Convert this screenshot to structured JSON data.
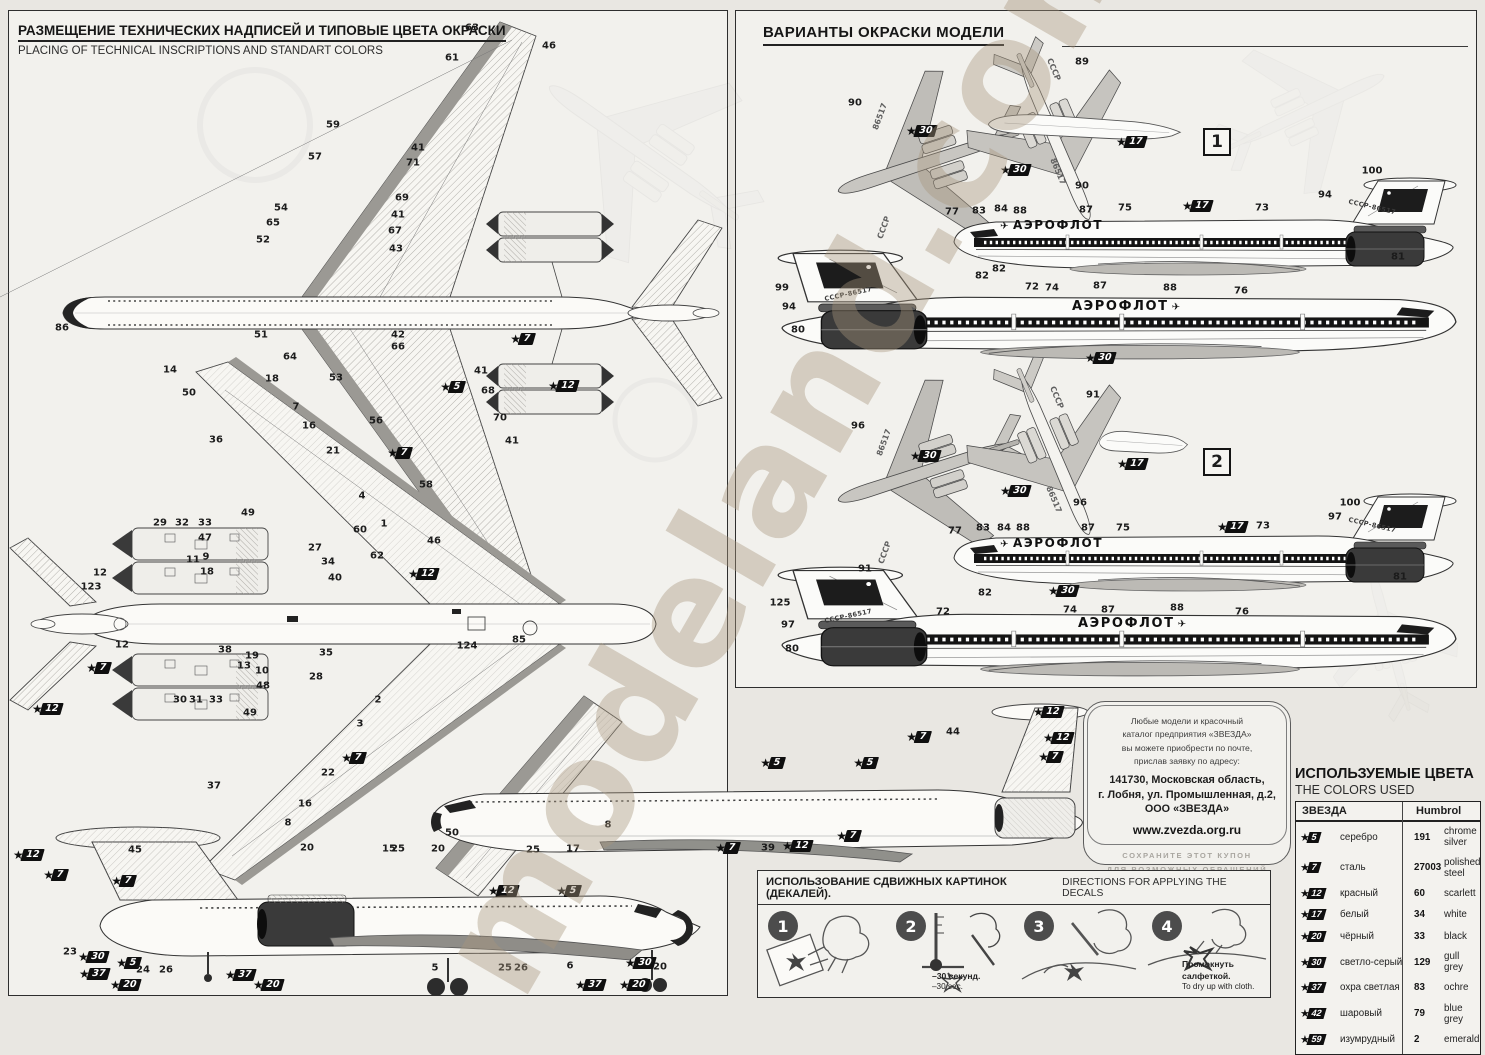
{
  "watermark": "modeland.com.ua",
  "left_panel": {
    "title_ru": "РАЗМЕЩЕНИЕ ТЕХНИЧЕСКИХ НАДПИСЕЙ И ТИПОВЫЕ ЦВЕТА ОКРАСКИ",
    "title_en": "PLACING OF TECHNICAL INSCRIPTIONS AND STANDART COLORS"
  },
  "right_panel": {
    "title_ru": "ВАРИАНТЫ ОКРАСКИ МОДЕЛИ",
    "variant1_label": "1",
    "variant2_label": "2",
    "airline_title": "АЭРОФЛОТ",
    "registration": "СССР-86517",
    "wing_code_top": "СССР",
    "wing_code_num": "86517"
  },
  "coupon": {
    "l1": "Любые модели и красочный",
    "l2": "каталог предприятия «ЗВЕЗДА»",
    "l3": "вы можете приобрести по почте,",
    "l4": "прислав заявку по адресу:",
    "addr1": "141730, Московская область,",
    "addr2": "г. Лобня, ул. Промышленная, д.2,",
    "addr3": "ООО «ЗВЕЗДА»",
    "site": "www.zvezda.org.ru",
    "note1": "СОХРАНИТЕ ЭТОТ КУПОН",
    "note2": "ДЛЯ ВОЗМОЖНЫХ ОБРАЩЕНИЙ"
  },
  "colors_table": {
    "title_ru": "ИСПОЛЬЗУЕМЫЕ ЦВЕТА",
    "title_en": "THE COLORS USED",
    "col_zvezda": "ЗВЕЗДА",
    "col_humbrol": "Humbrol",
    "rows": [
      {
        "zvezda": "5",
        "name_ru": "серебро",
        "humbrol": "191",
        "name_en": "chrome silver"
      },
      {
        "zvezda": "7",
        "name_ru": "сталь",
        "humbrol": "27003",
        "name_en": "polished steel"
      },
      {
        "zvezda": "12",
        "name_ru": "красный",
        "humbrol": "60",
        "name_en": "scarlett"
      },
      {
        "zvezda": "17",
        "name_ru": "белый",
        "humbrol": "34",
        "name_en": "white"
      },
      {
        "zvezda": "20",
        "name_ru": "чёрный",
        "humbrol": "33",
        "name_en": "black"
      },
      {
        "zvezda": "30",
        "name_ru": "светло-серый",
        "humbrol": "129",
        "name_en": "gull grey"
      },
      {
        "zvezda": "37",
        "name_ru": "охра светлая",
        "humbrol": "83",
        "name_en": "ochre"
      },
      {
        "zvezda": "42",
        "name_ru": "шаровый",
        "humbrol": "79",
        "name_en": "blue grey"
      },
      {
        "zvezda": "59",
        "name_ru": "изумрудный",
        "humbrol": "2",
        "name_en": "emerald"
      }
    ]
  },
  "decals": {
    "title_ru": "ИСПОЛЬЗОВАНИЕ СДВИЖНЫХ КАРТИНОК (ДЕКАЛЕЙ).",
    "title_en": "DIRECTIONS  FOR APPLYING THE DECALS",
    "steps": [
      {
        "num": "1"
      },
      {
        "num": "2",
        "note_ru": "–30 секунд.",
        "note_en": "–30 sec."
      },
      {
        "num": "3"
      },
      {
        "num": "4",
        "note_ru": "Промокнуть салфеткой.",
        "note_en": "To dry up with cloth."
      }
    ]
  },
  "callouts": [
    [
      "63",
      472,
      28
    ],
    [
      "46",
      549,
      46
    ],
    [
      "61",
      452,
      58
    ],
    [
      "59",
      333,
      125
    ],
    [
      "41",
      418,
      148
    ],
    [
      "57",
      315,
      157
    ],
    [
      "71",
      413,
      163
    ],
    [
      "69",
      402,
      198
    ],
    [
      "54",
      281,
      208
    ],
    [
      "41",
      398,
      215
    ],
    [
      "65",
      273,
      223
    ],
    [
      "67",
      395,
      231
    ],
    [
      "52",
      263,
      240
    ],
    [
      "43",
      396,
      249
    ],
    [
      "86",
      62,
      328
    ],
    [
      "51",
      261,
      335
    ],
    [
      "42",
      398,
      335
    ],
    [
      "66",
      398,
      347
    ],
    [
      "64",
      290,
      357
    ],
    [
      "41",
      481,
      371
    ],
    [
      "53",
      336,
      378
    ],
    [
      "68",
      488,
      391
    ],
    [
      "56",
      376,
      421
    ],
    [
      "70",
      500,
      418
    ],
    [
      "41",
      512,
      441
    ],
    [
      "58",
      426,
      485
    ],
    [
      "7",
      522,
      339,
      1
    ],
    [
      "5",
      452,
      387,
      1
    ],
    [
      "12",
      563,
      386,
      1
    ],
    [
      "7",
      399,
      453,
      1
    ],
    [
      "14",
      170,
      370
    ],
    [
      "50",
      189,
      393
    ],
    [
      "18",
      272,
      379
    ],
    [
      "7",
      296,
      407
    ],
    [
      "16",
      309,
      426
    ],
    [
      "36",
      216,
      440
    ],
    [
      "21",
      333,
      451
    ],
    [
      "4",
      362,
      496
    ],
    [
      "49",
      248,
      513
    ],
    [
      "1",
      384,
      524
    ],
    [
      "29",
      160,
      523
    ],
    [
      "32",
      182,
      523
    ],
    [
      "33",
      205,
      523
    ],
    [
      "47",
      205,
      538
    ],
    [
      "9",
      206,
      557
    ],
    [
      "11",
      193,
      560
    ],
    [
      "18",
      207,
      572
    ],
    [
      "12",
      100,
      573
    ],
    [
      "123",
      91,
      587
    ],
    [
      "12",
      122,
      645
    ],
    [
      "7",
      98,
      668,
      1
    ],
    [
      "12",
      47,
      709,
      1
    ],
    [
      "38",
      225,
      650
    ],
    [
      "19",
      252,
      656
    ],
    [
      "13",
      244,
      666
    ],
    [
      "10",
      262,
      671
    ],
    [
      "48",
      263,
      686
    ],
    [
      "30",
      180,
      700
    ],
    [
      "31",
      196,
      700
    ],
    [
      "33",
      216,
      700
    ],
    [
      "49",
      250,
      713
    ],
    [
      "27",
      315,
      548
    ],
    [
      "34",
      328,
      562
    ],
    [
      "40",
      335,
      578
    ],
    [
      "60",
      360,
      530
    ],
    [
      "62",
      377,
      556
    ],
    [
      "46",
      434,
      541
    ],
    [
      "12",
      423,
      574,
      1
    ],
    [
      "35",
      326,
      653
    ],
    [
      "28",
      316,
      677
    ],
    [
      "85",
      519,
      640
    ],
    [
      "124",
      467,
      646
    ],
    [
      "2",
      378,
      700
    ],
    [
      "3",
      360,
      724
    ],
    [
      "7",
      353,
      758,
      1
    ],
    [
      "22",
      328,
      773
    ],
    [
      "37",
      214,
      786
    ],
    [
      "16",
      305,
      804
    ],
    [
      "8",
      288,
      823
    ],
    [
      "50",
      452,
      833
    ],
    [
      "15",
      389,
      849
    ],
    [
      "17",
      573,
      849
    ],
    [
      "8",
      608,
      825
    ],
    [
      "12",
      503,
      891,
      1
    ],
    [
      "5",
      568,
      891,
      1
    ],
    [
      "12",
      28,
      855,
      1
    ],
    [
      "7",
      55,
      875,
      1
    ],
    [
      "45",
      135,
      850
    ],
    [
      "7",
      123,
      881,
      1
    ],
    [
      "23",
      70,
      952
    ],
    [
      "30",
      93,
      957,
      1
    ],
    [
      "5",
      128,
      963,
      1
    ],
    [
      "37",
      94,
      974,
      1
    ],
    [
      "20",
      125,
      985,
      1
    ],
    [
      "24",
      143,
      970
    ],
    [
      "26",
      166,
      970
    ],
    [
      "37",
      240,
      975,
      1
    ],
    [
      "20",
      268,
      985,
      1
    ],
    [
      "20",
      307,
      848
    ],
    [
      "25",
      398,
      849
    ],
    [
      "5",
      435,
      968
    ],
    [
      "25",
      505,
      968
    ],
    [
      "26",
      521,
      968
    ],
    [
      "6",
      570,
      966
    ],
    [
      "30",
      640,
      963,
      1
    ],
    [
      "20",
      660,
      967
    ],
    [
      "37",
      590,
      985,
      1
    ],
    [
      "20",
      634,
      985,
      1
    ],
    [
      "20",
      438,
      849
    ],
    [
      "25",
      533,
      850
    ],
    [
      "5",
      772,
      763,
      1
    ],
    [
      "7",
      727,
      848,
      1
    ],
    [
      "39",
      768,
      848
    ],
    [
      "12",
      797,
      846,
      1
    ],
    [
      "7",
      848,
      836,
      1
    ],
    [
      "44",
      953,
      732
    ],
    [
      "7",
      918,
      737,
      1
    ],
    [
      "12",
      1058,
      738,
      1
    ],
    [
      "7",
      1050,
      757,
      1
    ],
    [
      "5",
      865,
      763,
      1
    ],
    [
      "12",
      1048,
      712,
      1
    ],
    [
      "90",
      855,
      103
    ],
    [
      "89",
      1082,
      62
    ],
    [
      "30",
      921,
      131,
      1
    ],
    [
      "30",
      1015,
      170,
      1
    ],
    [
      "17",
      1131,
      142,
      1
    ],
    [
      "90",
      1082,
      186
    ],
    [
      "77",
      952,
      212
    ],
    [
      "83",
      979,
      211
    ],
    [
      "84",
      1001,
      209
    ],
    [
      "88",
      1020,
      211
    ],
    [
      "87",
      1086,
      210
    ],
    [
      "75",
      1125,
      208
    ],
    [
      "17",
      1197,
      206,
      1
    ],
    [
      "73",
      1262,
      208
    ],
    [
      "94",
      1325,
      195
    ],
    [
      "100",
      1372,
      171
    ],
    [
      "81",
      1398,
      257
    ],
    [
      "82",
      999,
      269
    ],
    [
      "99",
      782,
      288
    ],
    [
      "94",
      789,
      307
    ],
    [
      "80",
      798,
      330
    ],
    [
      "82",
      982,
      276
    ],
    [
      "72",
      1032,
      287
    ],
    [
      "74",
      1052,
      288
    ],
    [
      "87",
      1100,
      286
    ],
    [
      "88",
      1170,
      288
    ],
    [
      "76",
      1241,
      291
    ],
    [
      "30",
      1100,
      358,
      1
    ],
    [
      "96",
      858,
      426
    ],
    [
      "91",
      1093,
      395
    ],
    [
      "30",
      925,
      456,
      1
    ],
    [
      "30",
      1015,
      491,
      1
    ],
    [
      "17",
      1132,
      464,
      1
    ],
    [
      "96",
      1080,
      503
    ],
    [
      "77",
      955,
      531
    ],
    [
      "83",
      983,
      528
    ],
    [
      "84",
      1004,
      528
    ],
    [
      "88",
      1023,
      528
    ],
    [
      "87",
      1088,
      528
    ],
    [
      "75",
      1123,
      528
    ],
    [
      "17",
      1232,
      527,
      1
    ],
    [
      "73",
      1263,
      526
    ],
    [
      "100",
      1350,
      503
    ],
    [
      "97",
      1335,
      517
    ],
    [
      "82",
      985,
      593
    ],
    [
      "30",
      1063,
      591,
      1
    ],
    [
      "81",
      1400,
      577
    ],
    [
      "91",
      865,
      569
    ],
    [
      "125",
      780,
      603
    ],
    [
      "97",
      788,
      625
    ],
    [
      "80",
      792,
      649
    ],
    [
      "72",
      943,
      612
    ],
    [
      "74",
      1070,
      610
    ],
    [
      "87",
      1108,
      610
    ],
    [
      "88",
      1177,
      608
    ],
    [
      "76",
      1242,
      612
    ]
  ]
}
